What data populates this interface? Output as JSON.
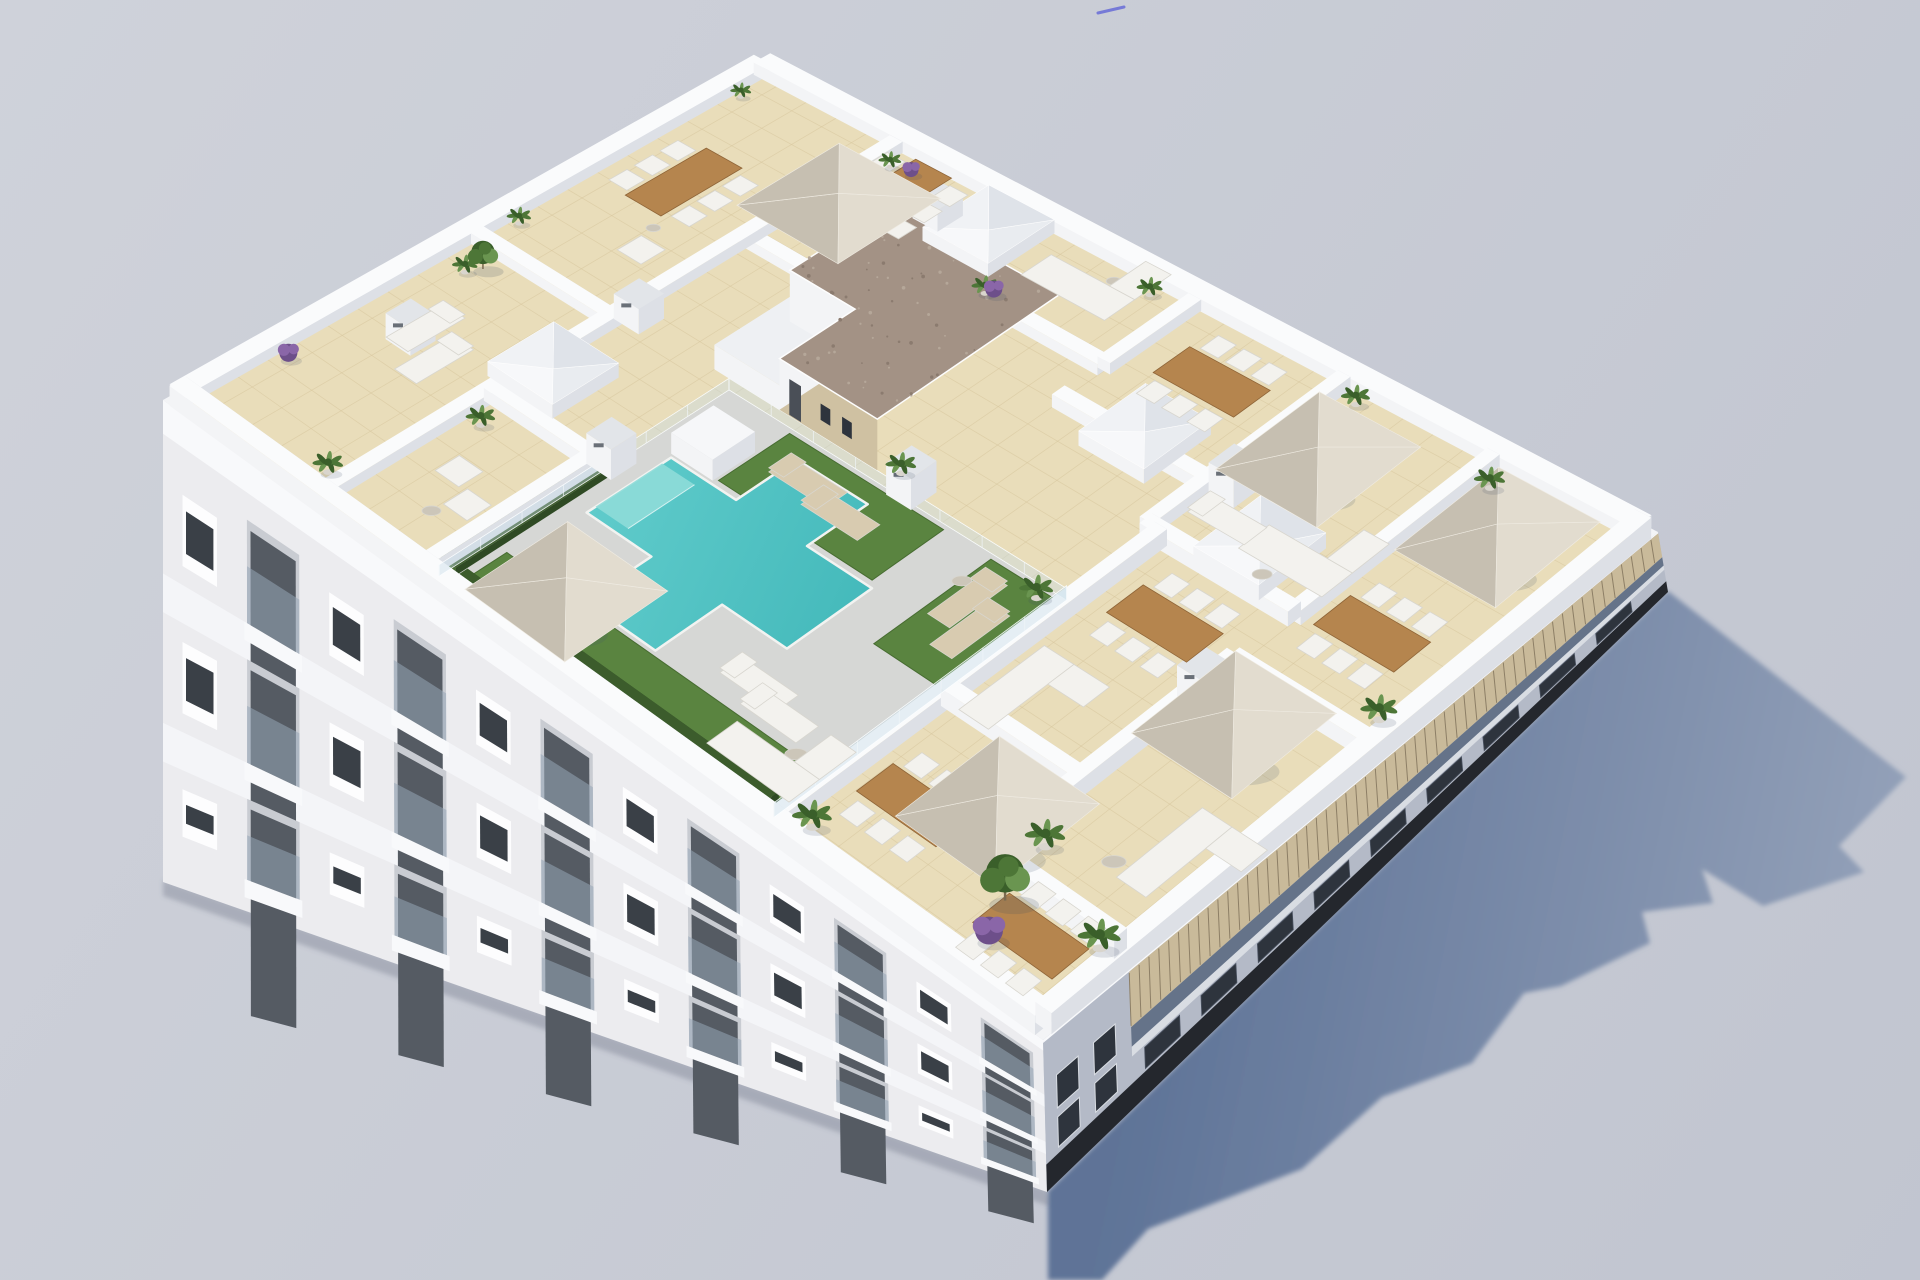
{
  "meta": {
    "type": "architectural-3d-render",
    "description": "Aerial isometric 3D rendering of a white apartment building rooftop: communal terrace with T-shaped turquoise pool, artificial grass, glass fencing, twelve private tiled terraces with beige parasols, wooden dining tables, white lounge sofas, sun loungers and potted plants, a central stair core with gravel roof, skylights and chimneys; long cast shadow to the lower right on a plain grey ground.",
    "counts": {
      "umbrellas": 6,
      "skylights": 4,
      "chimneys": 7,
      "terraces": 12,
      "pools": 1,
      "dining_tables": 7,
      "sofas": 5
    }
  },
  "colors": {
    "bg_top": "#cfd2da",
    "bg_bottom": "#c1c5d0",
    "shadow_near": "#5e7397",
    "shadow_far": "#97a4bb",
    "facade_sw": "#ececef",
    "cornice": "#f8f9fb",
    "slab": "#f4f5f8",
    "window_dark": "#3a4047",
    "window_frame": "#fdfdfe",
    "balcony_recess": "#c9ccd2",
    "balcony_glass": "rgba(150,165,182,0.55)",
    "facade_se": "#b4bac7",
    "plinth": "#24272d",
    "pergola": "#c9ba9a",
    "pergola_slat": "#8d7f66",
    "se_glass": "#5c6b82",
    "se_band": "#d9dde3",
    "se_window": "#2e343d",
    "parapet_top": "#fafbfc",
    "wall_bright": "#f3f4f6",
    "wall_shade": "#dde0e6",
    "tile": "#e9ddba",
    "tile_line": "#d6c59c",
    "deck": "#d6d7d5",
    "pool": "#55c6c7",
    "pool_deep": "#3cb4b6",
    "pool_steps": "#8edcd8",
    "pool_edge": "#f2f3f1",
    "grass": "#5a8440",
    "grass_dark": "#476c31",
    "hedge": "#3c5c2c",
    "hedge_side": "#2f4a24",
    "gravel": "#a39285",
    "gravel_dot": "#8b7b6f",
    "core_tan": "#cfc1a2",
    "core_door": "#4a4f57",
    "wood": "#b5854e",
    "wood_dark": "#8f6538",
    "furniture_white": "#f3f2ee",
    "furniture_shade": "#d8d6cf",
    "umbrella_light": "#e2dccf",
    "umbrella_dark": "#c6bfb1",
    "umbrella_pole": "#97978f",
    "lounger_tan": "#d8cbb0",
    "plant_g1": "#4d7637",
    "plant_g2": "#3a5f2a",
    "plant_g3": "#6a9550",
    "plant_purple": "#8a66a8",
    "plant_purple_dark": "#6d4f8a",
    "pot": "#d9d5cd",
    "trunk": "#7a6a50",
    "chimney_top": "#e2e5e9",
    "chimney_slot": "#6a7078",
    "glass_fence": "rgba(198,221,232,0.40)",
    "glass_edge": "rgba(252,254,255,0.9)",
    "round_table": "#ccc6b9",
    "base_shadow": "rgba(80,90,110,0.28)",
    "artifact": "#5b5fd8"
  },
  "projection": {
    "W": [
      163,
      400
    ],
    "N": [
      762,
      62
    ],
    "E": [
      1658,
      532
    ],
    "S": [
      1043,
      1040
    ],
    "plan": [
      30,
      20
    ]
  },
  "facade_sw": {
    "top_left": [
      163,
      400
    ],
    "top_right": [
      1043,
      1040
    ],
    "bottom_left": [
      163,
      882
    ],
    "bottom_right": [
      1047,
      1192
    ],
    "bays": 12,
    "rows": [
      {
        "f1": 0.13,
        "f2": 0.36
      },
      {
        "f1": 0.44,
        "f2": 0.67
      },
      {
        "f1": 0.75,
        "f2": 0.93
      }
    ]
  },
  "facade_se": {
    "top_left": [
      1043,
      1040
    ],
    "top_right": [
      1658,
      532
    ],
    "bottom_left": [
      1047,
      1192
    ],
    "bottom_right": [
      1668,
      592
    ],
    "pergola_t0": 0.14,
    "window_bays": 9
  },
  "shadow": {
    "points": [
      [
        1048,
        1191
      ],
      [
        1355,
        893
      ],
      [
        1668,
        591
      ],
      [
        1906,
        777
      ],
      [
        1839,
        846
      ],
      [
        1864,
        872
      ],
      [
        1763,
        906
      ],
      [
        1702,
        869
      ],
      [
        1713,
        903
      ],
      [
        1642,
        912
      ],
      [
        1650,
        943
      ],
      [
        1561,
        986
      ],
      [
        1524,
        993
      ],
      [
        1472,
        1063
      ],
      [
        1382,
        1097
      ],
      [
        1302,
        1169
      ],
      [
        1148,
        1229
      ],
      [
        1102,
        1280
      ],
      [
        1048,
        1280
      ]
    ]
  },
  "roof": {
    "floor": [
      0.45,
      0.45,
      29.55,
      19.55
    ],
    "parapet": [
      [
        0.25,
        0.25,
        29.75,
        0.25
      ],
      [
        29.75,
        0.25,
        29.75,
        19.75
      ],
      [
        0.25,
        19.75,
        29.75,
        19.75
      ],
      [
        0.25,
        0.25,
        0.25,
        19.75
      ]
    ],
    "walls": [
      [
        5,
        0.5,
        5,
        19.5
      ],
      [
        8.5,
        0.5,
        8.5,
        6
      ],
      [
        5,
        6,
        8.5,
        6
      ],
      [
        0.5,
        10,
        5,
        10
      ],
      [
        5,
        14.5,
        10,
        14.5
      ],
      [
        10,
        14.5,
        10,
        19.5
      ],
      [
        15,
        16.5,
        15,
        19.5
      ],
      [
        10,
        16.5,
        15,
        16.5
      ],
      [
        15,
        15,
        20,
        15
      ],
      [
        20,
        13,
        20,
        19.5
      ],
      [
        20,
        13,
        25,
        13
      ],
      [
        25,
        13,
        25,
        19.5
      ],
      [
        25,
        11,
        29.5,
        11
      ],
      [
        20.5,
        6,
        25,
        6
      ],
      [
        25,
        3,
        25,
        11
      ],
      [
        25,
        3,
        29.5,
        3
      ],
      [
        20.5,
        0.5,
        20.5,
        13
      ]
    ],
    "deck": [
      8.8,
      0.45,
      20.2,
      10.2
    ],
    "grass": [
      [
        11,
        7.7,
        16.2,
        10.05
      ],
      [
        9.3,
        1.05,
        19.9,
        2.35
      ],
      [
        17.8,
        6.2,
        20.05,
        10.05
      ]
    ],
    "hedges": [
      [
        9.3,
        0.8,
        19.9,
        0.8
      ],
      [
        8.8,
        0.9,
        8.8,
        6.4
      ]
    ],
    "fence": [
      [
        8.8,
        0.6,
        8.8,
        10.2
      ],
      [
        8.8,
        10.2,
        20.2,
        10.2
      ],
      [
        20.2,
        0.6,
        20.2,
        10.2
      ]
    ],
    "pool": {
      "a": [
        9.6,
        4.7,
        16.4,
        7.5
      ],
      "b": [
        11.8,
        2.5,
        14.2,
        9.5
      ],
      "steps": [
        9.6,
        5.0,
        10.7,
        7.2
      ]
    },
    "core": {
      "rect": [
        8,
        10.5,
        13.5,
        16.5
      ],
      "notch": [
        8,
        10.5,
        10.2,
        13
      ]
    },
    "planter": [
      10.2,
      8.3,
      1.4
    ],
    "skylights": [
      [
        5.5,
        7.6
      ],
      [
        9.2,
        18.4
      ],
      [
        17.6,
        15.3
      ],
      [
        22.7,
        14.1
      ]
    ],
    "chimneys": [
      [
        5.35,
        10.6
      ],
      [
        8.75,
        6.35
      ],
      [
        14.7,
        10.45
      ],
      [
        7.7,
        18.2
      ],
      [
        20.6,
        15.3
      ],
      [
        25.2,
        9.8
      ],
      [
        2.2,
        6.1
      ]
    ],
    "umbrellas": [
      [
        12.2,
        1.5
      ],
      [
        6.4,
        16.2
      ],
      [
        22.3,
        16.4
      ],
      [
        27.8,
        16.9
      ],
      [
        27.3,
        8.8
      ],
      [
        25.0,
        3.3
      ]
    ],
    "tables": [
      [
        2.4,
        15.0,
        "v"
      ],
      [
        6.4,
        18.0,
        "v"
      ],
      [
        17.5,
        17.6,
        "u"
      ],
      [
        27.0,
        13.6,
        "u"
      ],
      [
        22.8,
        10.9,
        "u"
      ],
      [
        22.6,
        2.9,
        "u"
      ],
      [
        27.7,
        1.8,
        "u"
      ]
    ],
    "round_tables": [
      [
        3.2,
        13.2
      ],
      [
        7.2,
        1.9
      ],
      [
        12.9,
        18.9
      ],
      [
        23.4,
        13.5
      ],
      [
        27.5,
        4.7
      ],
      [
        19.3,
        2.2
      ],
      [
        18.0,
        8.9
      ]
    ],
    "sofas": [
      [
        12.4,
        18.2,
        "u"
      ],
      [
        23.7,
        14.3,
        "u"
      ],
      [
        28.4,
        5.8,
        "v"
      ],
      [
        18.9,
        1.5,
        "u"
      ],
      [
        21.6,
        7.2,
        "v"
      ]
    ],
    "armchairs": [
      [
        6.6,
        3.4
      ],
      [
        7.6,
        2.7
      ],
      [
        3.6,
        12.4
      ]
    ],
    "loungers": [
      [
        12.7,
        9.0,
        "u",
        "tan"
      ],
      [
        14.1,
        8.7,
        "u",
        "tan"
      ],
      [
        18.5,
        8.6,
        "v",
        "tan"
      ],
      [
        19.3,
        7.9,
        "v",
        "tan"
      ],
      [
        16.9,
        3.3,
        "u",
        "wht"
      ],
      [
        18.0,
        2.9,
        "u",
        "wht"
      ],
      [
        2.2,
        6.6,
        "v",
        "wht"
      ],
      [
        3.2,
        5.9,
        "v",
        "wht"
      ],
      [
        21.3,
        14.4,
        "u",
        "wht"
      ]
    ],
    "plants_green": [
      [
        0.7,
        18.6
      ],
      [
        0.7,
        11.2
      ],
      [
        1.2,
        8.9
      ],
      [
        4.4,
        1.2
      ],
      [
        5.6,
        5.1
      ],
      [
        5.4,
        18.9
      ],
      [
        10.7,
        16.8
      ],
      [
        14.0,
        10.8
      ],
      [
        19.6,
        9.8
      ],
      [
        20.7,
        19.2
      ],
      [
        25.5,
        18.9
      ],
      [
        29.0,
        11.9
      ],
      [
        25.7,
        4.2
      ],
      [
        21.1,
        1.0
      ],
      [
        29.0,
        2.8
      ],
      [
        13.8,
        19.2
      ]
    ],
    "plants_purple": [
      [
        0.8,
        3.4
      ],
      [
        10.9,
        16.9
      ],
      [
        26.8,
        1.3
      ],
      [
        6.0,
        19.0
      ]
    ],
    "trees": [
      [
        26.2,
        2.4
      ],
      [
        1.4,
        9.3
      ]
    ]
  },
  "artifact": {
    "x1": 1098,
    "y1": 13,
    "x2": 1124,
    "y2": 7
  }
}
